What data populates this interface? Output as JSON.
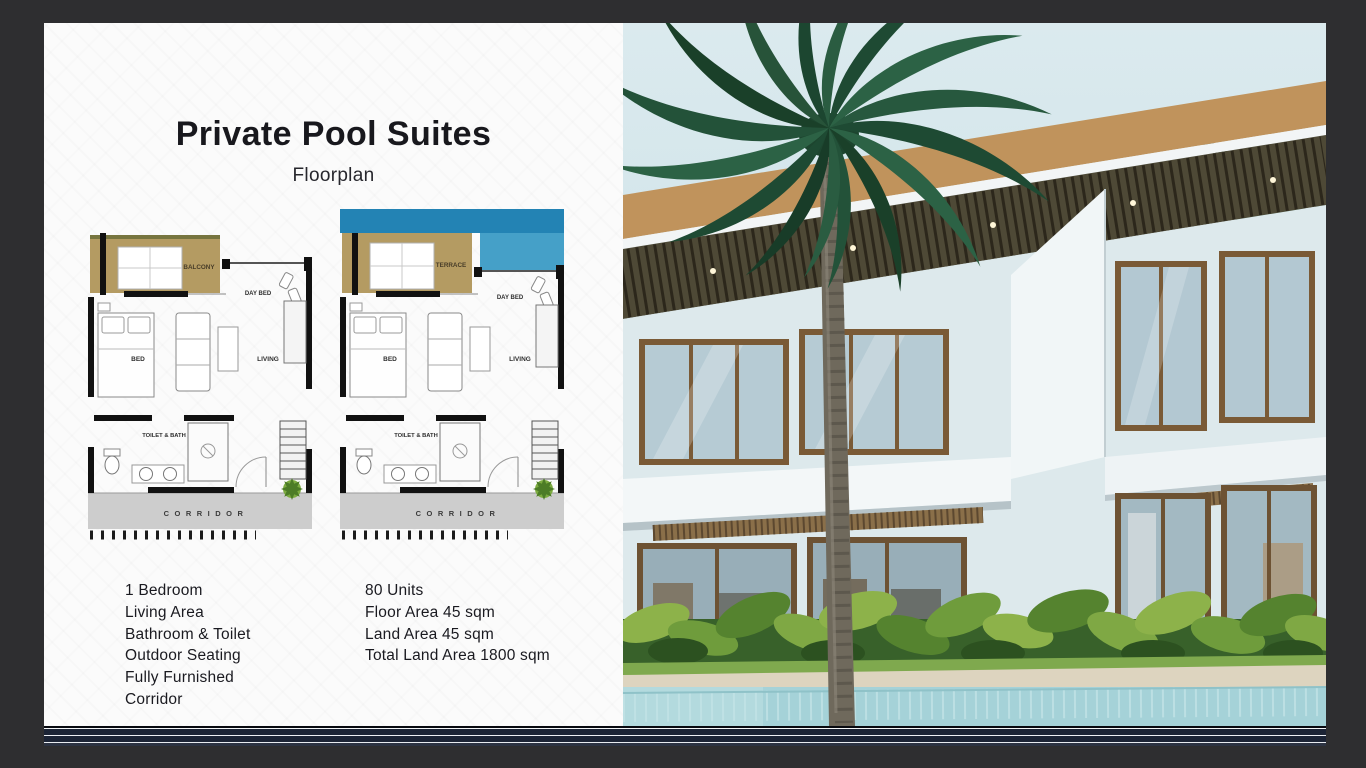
{
  "slide": {
    "title": "Private Pool Suites",
    "subtitle": "Floorplan",
    "floorplans": [
      {
        "outdoor_label": "BALCONY",
        "daybed_label": "DAY BED",
        "bed_label": "BED",
        "living_label": "LIVING",
        "bath_label": "TOILET & BATH",
        "corridor_label": "CORRIDOR"
      },
      {
        "outdoor_label": "TERRACE",
        "daybed_label": "DAY BED",
        "bed_label": "BED",
        "living_label": "LIVING",
        "bath_label": "TOILET & BATH",
        "corridor_label": "CORRIDOR"
      }
    ],
    "features": [
      "1 Bedroom",
      "Living Area",
      "Bathroom & Toilet",
      "Outdoor Seating",
      "Fully Furnished",
      "Corridor"
    ],
    "specs": [
      "80 Units",
      "Floor Area 45 sqm",
      "Land Area 45 sqm",
      "Total Land Area 1800 sqm"
    ]
  },
  "colors": {
    "surround_background": "#2e2e30",
    "stripe_navy": "#1c2435",
    "plan_wood_tan": "#b49b62",
    "plan_pool_blue": "#2383b4",
    "corridor_gray": "#cdcdcd",
    "plant_green": "#7cab40"
  }
}
